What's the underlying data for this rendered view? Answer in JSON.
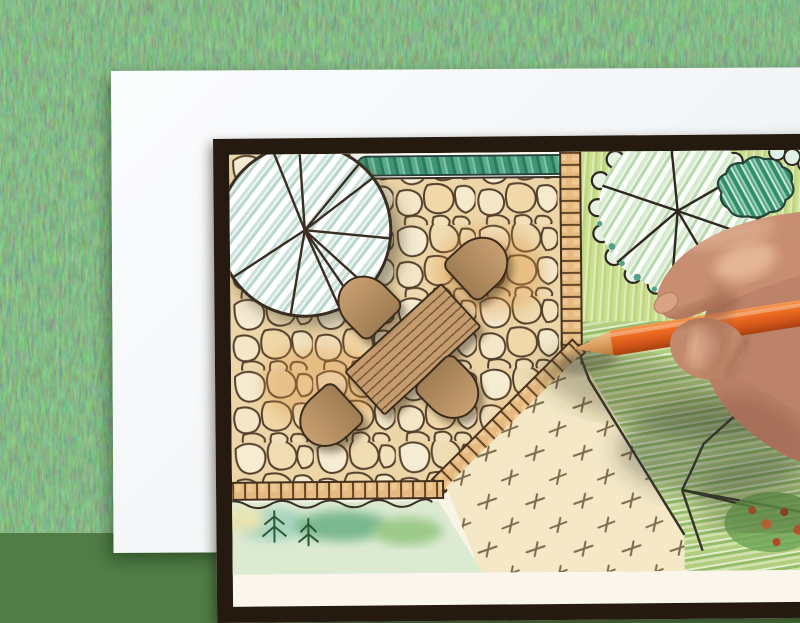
{
  "scene": {
    "type": "photograph",
    "description": "Overhead photo of a right hand holding an orange colored pencil while drawing a landscape architecture garden plan on a white sheet of paper that lies on green grass",
    "background": "green grass lawn",
    "no_text_visible": true
  },
  "palette": {
    "grass_green": "#4f7d45",
    "paper_white": "#f5f6f8",
    "plan_frame_dark": "#241a10",
    "flagstone_cream": "#f2e2bc",
    "stone_outline_brown": "#54402c",
    "brick_edging_tan": "#e6ba7e",
    "hedge_teal": "#3f9478",
    "tree_canopy_hatch": "#cde2da",
    "planting_ground_green": "#cfe096",
    "lawn_panel_tan": "#f4e8c6",
    "furniture_brown": "#b8926a",
    "pencil_orange": "#e8631c",
    "hand_skin": "#c78e71"
  },
  "plan_elements": {
    "patio": "flagstone paving",
    "large_tree_top_left": "round canopy with radiating branch lines and blue-green hatching",
    "hedge": "teal scribbled hedge strip along top edge",
    "table": "rectangular wooden plank table",
    "chair_count": 4,
    "edging": "brick border strips around patio",
    "lawn_panel": "tan lawn square with dashed grass ticks",
    "planting_bed_right": "green bed with scalloped-edge tree and striped shrub",
    "bottom_bed": "watercolor shrub bed with conifer sprigs",
    "corner_feature": "rock and flower planting lines in lower-right corner"
  },
  "foreground": {
    "pencil": {
      "type": "colored pencil",
      "body_color": "#e8631c",
      "wood_tip": "#dda express15c",
      "note": "sharpened tip touching patio corner"
    },
    "hand": "right hand gripping pencil between thumb and index finger, entering from right edge"
  }
}
